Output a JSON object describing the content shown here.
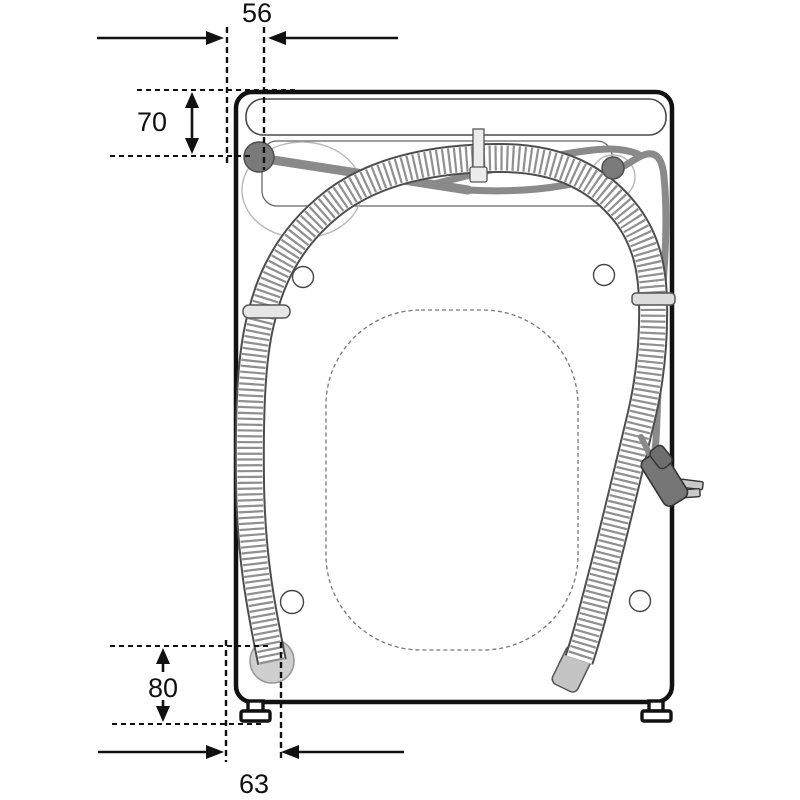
{
  "diagram": {
    "type": "washing-machine-rear-view-installation-diagram",
    "dimensions": {
      "hose_top_offset": "56",
      "inlet_valve_drop": "70",
      "drain_outlet_height": "80",
      "hose_bottom_offset": "63"
    },
    "colors": {
      "line": "#1a1a1a",
      "power_cord": "#8a8a8a",
      "inlet_valve": "#7a7a7a",
      "drain_boss": "#cfcfcf",
      "hose_clip": "#e6e6e6",
      "background": "#ffffff"
    }
  }
}
